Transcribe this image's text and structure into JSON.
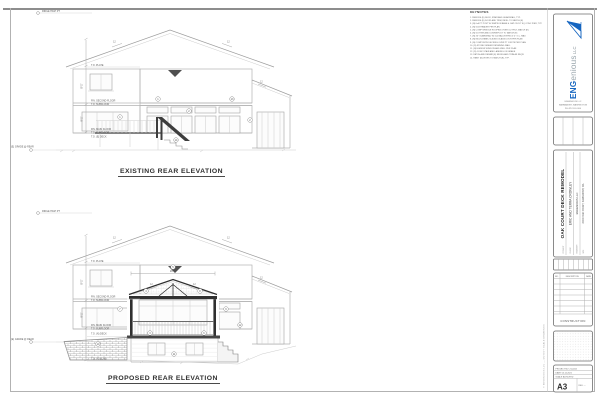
{
  "titles": {
    "existing": "EXISTING REAR ELEVATION",
    "proposed": "PROPOSED REAR ELEVATION"
  },
  "keynotes": {
    "title": "KEYNOTES",
    "items": [
      "1.  REMOVE (E) DECK, STAIR AND GUARDRAIL, TYP.",
      "2.  REMOVE (E) DOOR AND TRIM, INFILL TO MATCH (E)",
      "3.  (N) 6x6 PT POST W/ SIMPSON BASE & CAP ON 18\" SQ CONC PIER, TYP.",
      "4.  (N) GLB HEADER PER PLAN",
      "5.  (N) COMP SHINGLE ROOFING OVER 15# FELT, MATCH (E)",
      "6.  (N) GUTTER AND DOWNSPOUT TO MATCH (E)",
      "7.  (N) 36\" GUARDRAIL W/ 2x2 BALUSTERS @ 4\" O.C. MAX",
      "8.  (N) MULTI-PANEL SLIDING GLASS DOOR PER PLAN",
      "9.  (N) COMPOSITE DECKING OVER PT JOISTS PER PLAN",
      "10. (N) STONE VENEER RETAINING WALL",
      "11. (N) EGRESS WINDOW AND WELL PER PLAN",
      "12. (N) CONC STAIR AND LANDING ON GRADE",
      "13. PATCH AND REPAIR (E) SIDING AND TRIM AS REQ'D",
      "14. PAINT (N) WORK TO MATCH (E), TYP."
    ]
  },
  "markers": {
    "ridge": "RIDGE HIGH PT",
    "plate2": "T.O. PLATE",
    "fin2": "FIN. SECOND FLOOR",
    "sub2": "T.O. SUBFLOOR",
    "fin1": "FIN. MAIN FLOOR",
    "sub1": "T.O. SUBFLOOR",
    "deck_e": "T.O. (E) DECK",
    "deck_n": "T.O. (N) DECK",
    "slab_n": "T.O. (N) SLAB",
    "grade_e": "(E) GRADE @ REAR",
    "dim_upper": "8'-1\"",
    "dim_lower": "9'-1\"",
    "porch_dim": "16'-0\"",
    "pitch": "12"
  },
  "bubbles_existing": [
    "1",
    "2",
    "1",
    "13",
    "2",
    "14"
  ],
  "bubbles_proposed": [
    "5",
    "4",
    "8",
    "7",
    "9",
    "3",
    "10",
    "12",
    "11",
    "6"
  ],
  "titleblock": {
    "logo": {
      "eng": "ENG",
      "enious": "enious",
      "llc": " LLC",
      "contact1": "ENGENIOUS LLC",
      "contact2": "SAMMAMISH, WASHINGTON",
      "contact3": "PH 425.555.0100"
    },
    "project": {
      "label1": "PROJECT",
      "name": "OAK COURT DECK REMODEL",
      "label2": "CLIENT",
      "client": "ERIC AND TERRA CROWLEY",
      "label3": "ENGINEER",
      "firm": "ENGENIOUS LLC",
      "label4": "SITE",
      "address": "20000 OAK COURT, SAMMAMISH, WA"
    },
    "revisions": {
      "col_no": "NO.",
      "col_desc": "DESCRIPTION",
      "col_date": "DATE",
      "status": "CONSTRUCTION"
    },
    "sheetbox": {
      "row1": "PROJECT NO: 21-0412",
      "row2": "DATE: 05.12.2021",
      "row3": "SCALE: AS NOTED",
      "number": "A3",
      "side": "REV: —"
    },
    "copyright": "© ENGENIOUS LLC — DO NOT SCALE DRAWINGS"
  }
}
